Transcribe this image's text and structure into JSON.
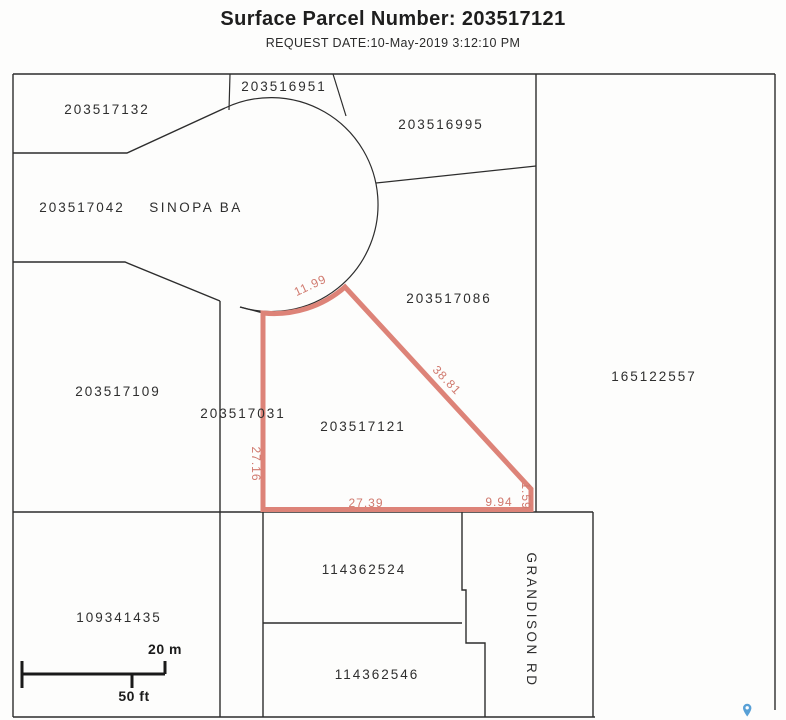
{
  "header": {
    "title": "Surface Parcel Number: 203517121",
    "request_date": "REQUEST DATE:10-May-2019 3:12:10 PM"
  },
  "map": {
    "parcels": {
      "p203517132": "203517132",
      "p203516951": "203516951",
      "p203516995": "203516995",
      "p203517042": "203517042",
      "p203517086": "203517086",
      "p165122557": "165122557",
      "p203517109": "203517109",
      "p203517031": "203517031",
      "p203517121": "203517121",
      "p114362524": "114362524",
      "p114362546": "114362546",
      "p109341435": "109341435"
    },
    "streets": {
      "sinopa": "SINOPA BA",
      "grandison": "GRANDISON RD"
    },
    "highlighted_parcel": {
      "id": "203517121",
      "dimensions": {
        "arc_north": "11.99",
        "northeast_diagonal": "38.81",
        "west_side": "27.16",
        "south_main": "27.39",
        "south_east": "9.94",
        "east_side": "1.59"
      }
    },
    "scale_bar": {
      "metric": "20 m",
      "imperial": "50 ft"
    }
  },
  "colors": {
    "highlight_stroke": "#dd8378",
    "dimension_text": "#d0796e",
    "map_line": "#2d2d2d",
    "pin_blue": "#58a0d6"
  }
}
